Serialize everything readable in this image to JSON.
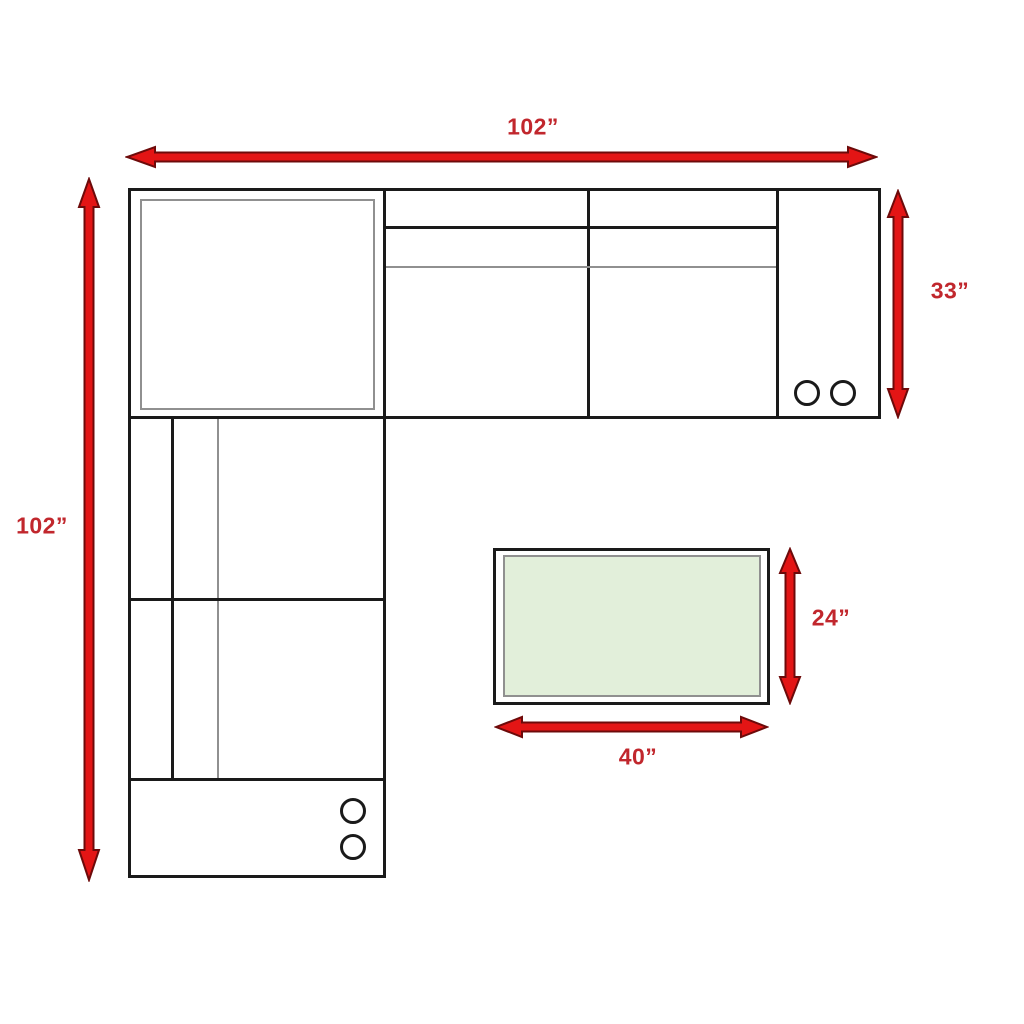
{
  "diagram": {
    "type": "furniture-dimension-floor-plan",
    "subject": "L-shaped sectional sofa with corner seat, consoles with cupholders, and ottoman",
    "colors": {
      "arrow_fill": "#e31515",
      "arrow_outline": "#6d0a0a",
      "label_red": "#c1272d",
      "line_black": "#1a1a1a",
      "line_gray": "#909090",
      "ottoman_fill": "#e2efda"
    },
    "dimensions": {
      "sofa_top_width": "102”",
      "sofa_left_height": "102”",
      "sofa_right_depth": "33”",
      "ottoman_height": "24”",
      "ottoman_width": "40”"
    },
    "icons": [
      {
        "name": "cupholder-circle",
        "count": 4
      }
    ]
  }
}
